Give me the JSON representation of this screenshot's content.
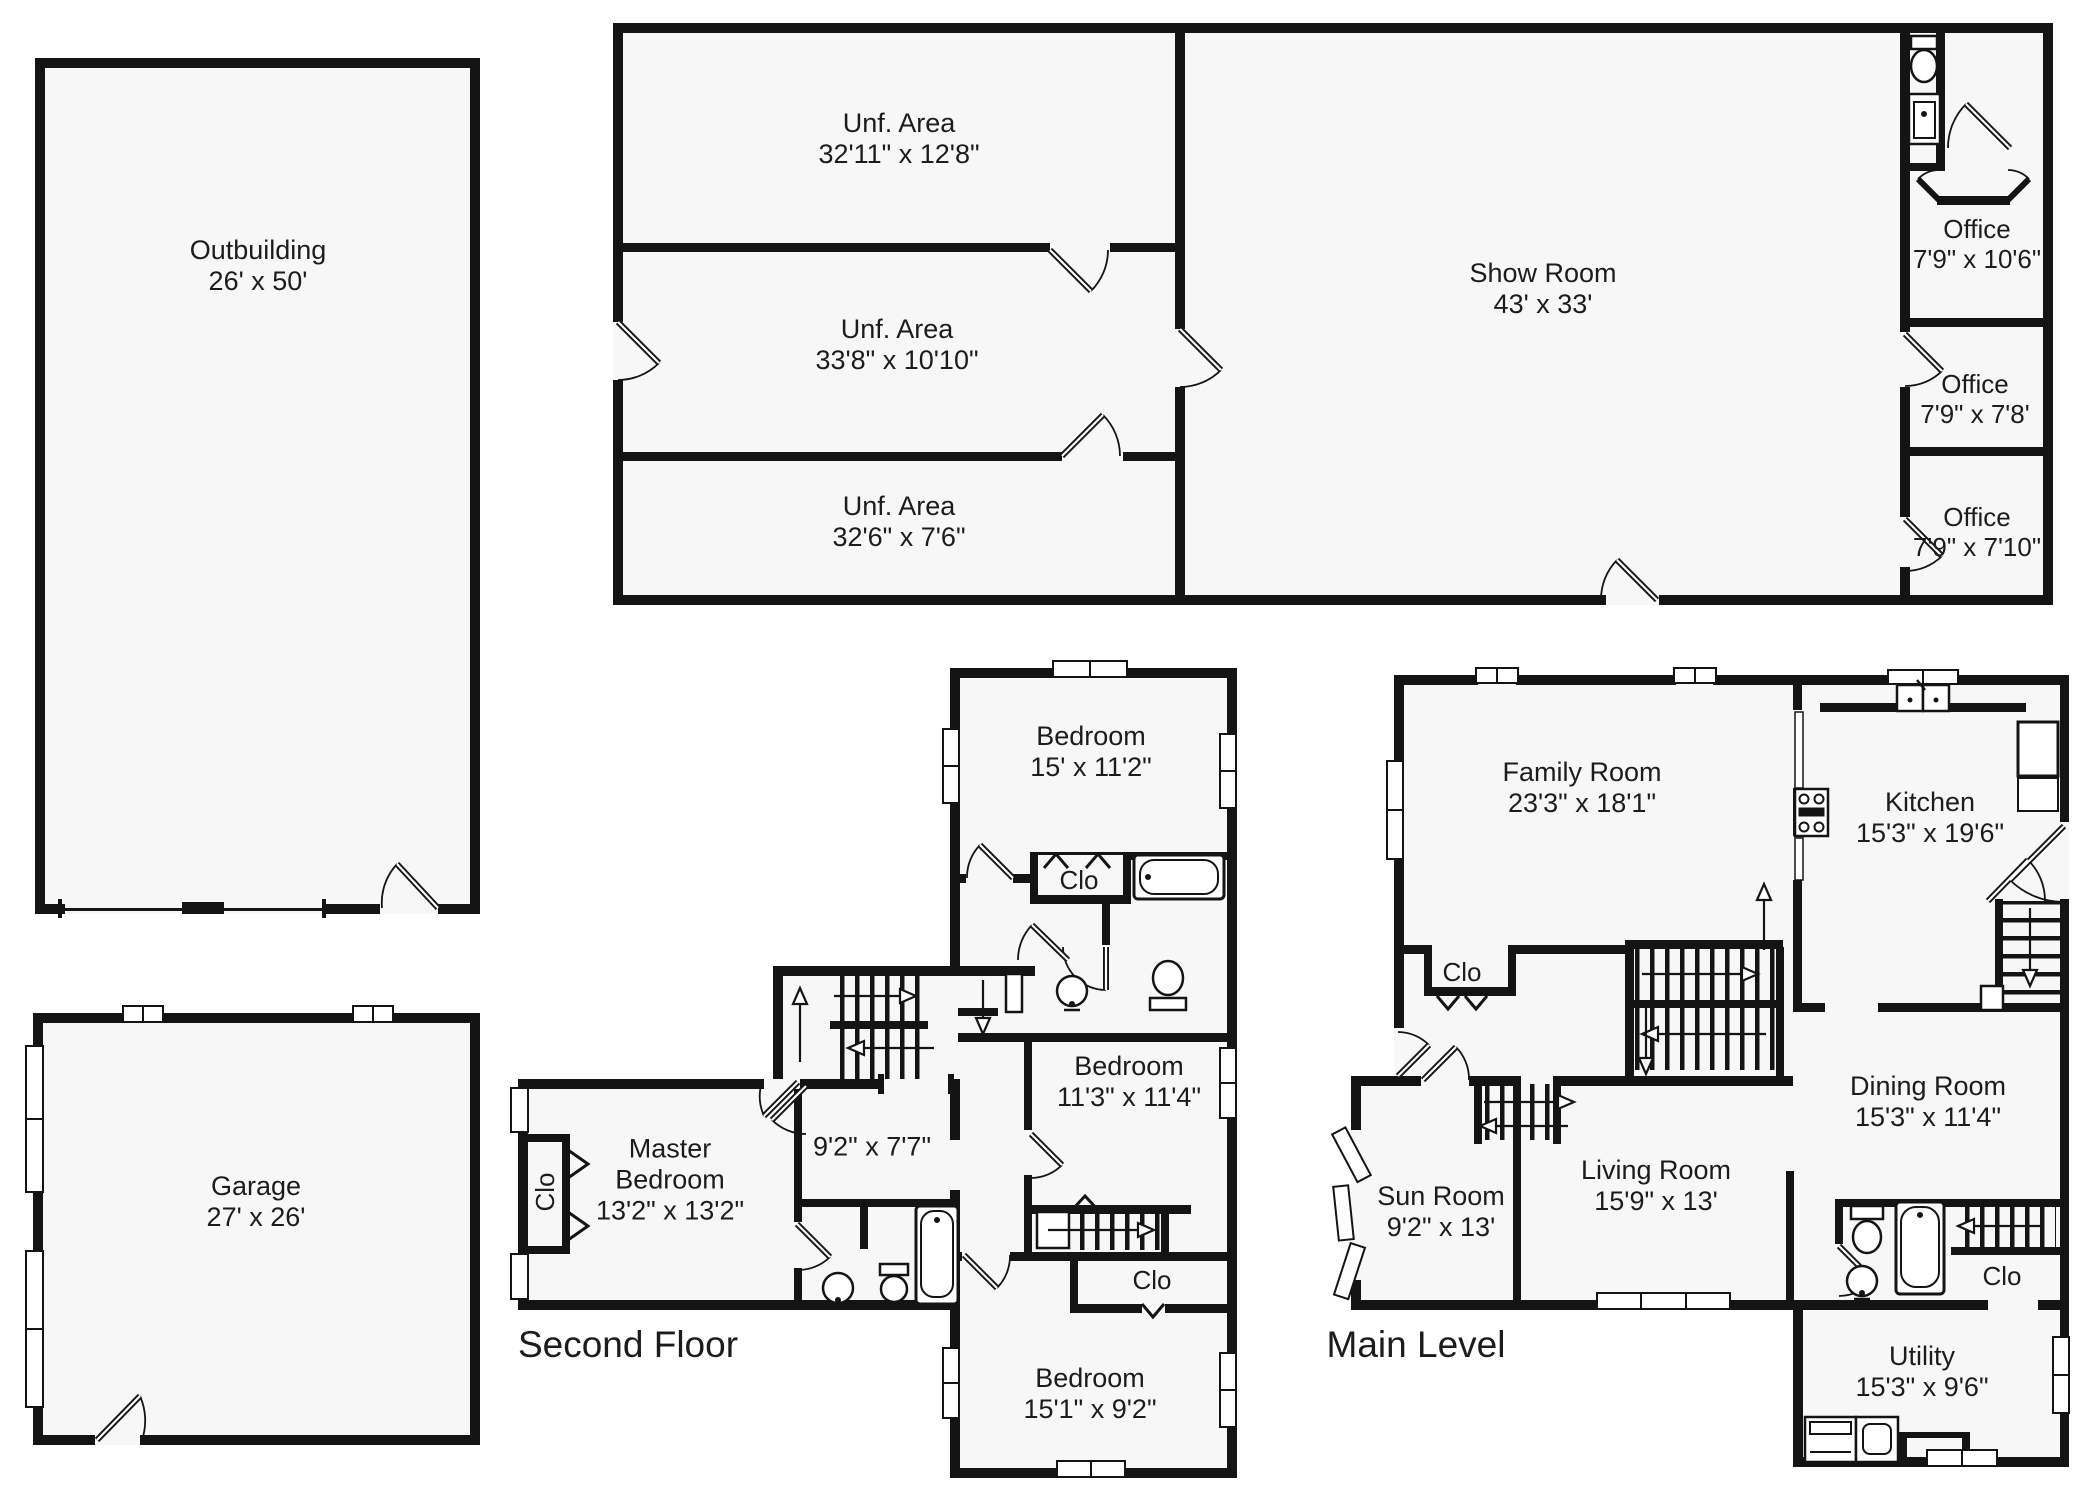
{
  "colors": {
    "wall": "#141414",
    "room_fill": "#f7f7f7",
    "background": "#ffffff"
  },
  "rooms": {
    "outbuilding": {
      "name": "Outbuilding",
      "dims": "26' x 50'"
    },
    "unf_area_1": {
      "name": "Unf. Area",
      "dims": "32'11\" x 12'8\""
    },
    "unf_area_2": {
      "name": "Unf. Area",
      "dims": "33'8\" x 10'10\""
    },
    "unf_area_3": {
      "name": "Unf. Area",
      "dims": "32'6\" x 7'6\""
    },
    "show_room": {
      "name": "Show Room",
      "dims": "43' x 33'"
    },
    "office_1": {
      "name": "Office",
      "dims": "7'9\" x 10'6\""
    },
    "office_2": {
      "name": "Office",
      "dims": "7'9\" x 7'8'"
    },
    "office_3": {
      "name": "Office",
      "dims": "7'9\" x 7'10\""
    },
    "garage": {
      "name": "Garage",
      "dims": "27' x 26'"
    },
    "bedroom_top": {
      "name": "Bedroom",
      "dims": "15' x 11'2\""
    },
    "bedroom_mid": {
      "name": "Bedroom",
      "dims": "11'3\" x 11'4\""
    },
    "bedroom_bottom": {
      "name": "Bedroom",
      "dims": "15'1\" x 9'2\""
    },
    "master_bedroom": {
      "name": "Master",
      "name2": "Bedroom",
      "dims": "13'2\" x 13'2\""
    },
    "hall_room": {
      "dims": "9'2\" x 7'7\""
    },
    "family_room": {
      "name": "Family Room",
      "dims": "23'3\" x 18'1\""
    },
    "kitchen": {
      "name": "Kitchen",
      "dims": "15'3\" x 19'6\""
    },
    "dining_room": {
      "name": "Dining Room",
      "dims": "15'3\" x 11'4\""
    },
    "living_room": {
      "name": "Living Room",
      "dims": "15'9\" x 13'"
    },
    "sun_room": {
      "name": "Sun Room",
      "dims": "9'2\" x 13'"
    },
    "utility": {
      "name": "Utility",
      "dims": "15'3\" x 9'6\""
    }
  },
  "closets": {
    "c1": "Clo",
    "c2": "Clo",
    "c3": "Clo",
    "c4": "Clo",
    "c5": "Clo"
  },
  "floor_labels": {
    "second": "Second Floor",
    "main": "Main Level"
  }
}
